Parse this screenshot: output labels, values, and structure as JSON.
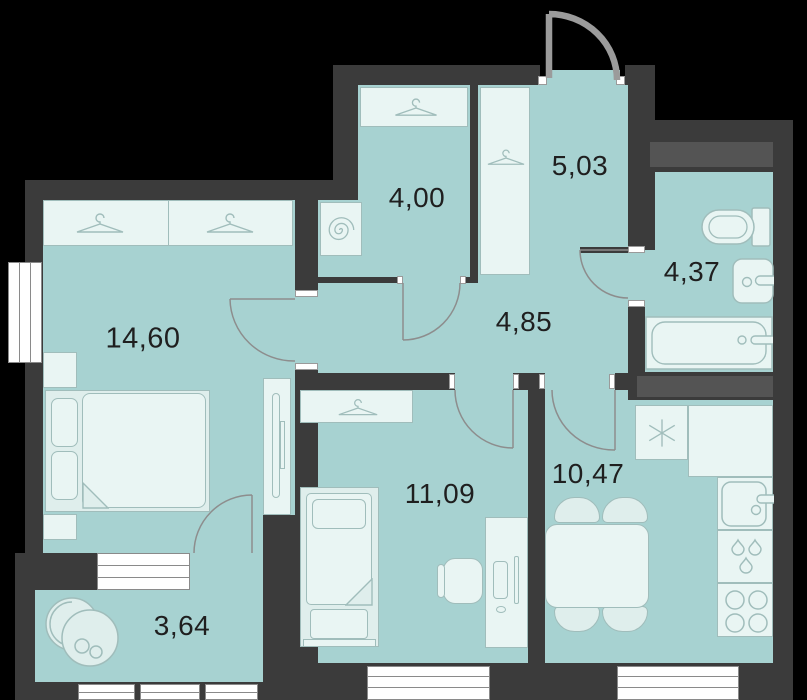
{
  "plan": {
    "title": "apartment-floor-plan",
    "rooms": {
      "bedroom": {
        "area": "14,60"
      },
      "dressing": {
        "area": "4,00"
      },
      "entry": {
        "area": "5,03"
      },
      "corridor": {
        "area": "4,85"
      },
      "bathroom": {
        "area": "4,37"
      },
      "child": {
        "area": "11,09"
      },
      "kitchen": {
        "area": "10,47"
      },
      "balcony": {
        "area": "3,64"
      }
    },
    "icons": [
      "hanger-icon",
      "washing-machine-spiral-icon",
      "boiler-asterisk-icon",
      "water-drops-icon",
      "stove-burners-icon"
    ],
    "colors": {
      "wall": "#3b3b3b",
      "floor": "#a7d2d1",
      "furniture": "#dfeeec",
      "furniture_stroke": "#a0bdbb",
      "door_arc": "#8d8d8d",
      "label": "#1f1f1f",
      "window": "#ffffff"
    }
  }
}
